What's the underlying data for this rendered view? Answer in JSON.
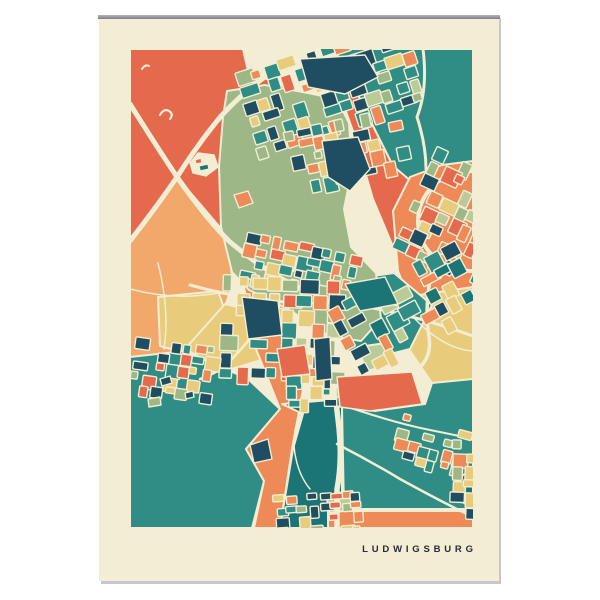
{
  "poster": {
    "title": "LUDWIGSBURG",
    "background_color": "#f2edd3",
    "title_color": "#2b2b33",
    "top_edge_color": "#8e8b9b",
    "shadow_color": "#c6c6ce"
  },
  "palette": {
    "cream": "#f2edd3",
    "salmon": "#e5694c",
    "orange": "#ee8a57",
    "lightOrange": "#f2a86b",
    "yellow": "#e9cc7b",
    "sage": "#9db886",
    "lightSage": "#bacb97",
    "teal": "#2f8d85",
    "darkTeal": "#1b7577",
    "navy": "#1f4d61",
    "ink": "#2b2b33"
  },
  "map": {
    "width": 343,
    "height": 479,
    "fields": [
      {
        "name": "left-meadow",
        "color": "lightOrange",
        "points": "0,192 47,128 100,190 102,238 88,276 60,312 0,316"
      },
      {
        "name": "left-field-1",
        "color": "yellow",
        "points": "28,248 88,242 100,276 62,306 30,297"
      },
      {
        "name": "left-field-2",
        "color": "yellow",
        "points": "55,300 95,255 150,268 148,306 95,322"
      },
      {
        "name": "northwest-district",
        "color": "salmon",
        "points": "0,0 113,0 118,22 160,40 178,62 150,120 108,176 100,190 47,128 0,192"
      },
      {
        "name": "northeast-forest",
        "color": "teal",
        "points": "203,0 343,0 343,116 302,150 263,117 233,57 216,18"
      },
      {
        "name": "northeast-band",
        "color": "salmon",
        "points": "216,18 233,57 263,117 302,150 308,190 288,225 266,205 243,150 224,85 208,40"
      },
      {
        "name": "east-ring-district",
        "color": "orange",
        "points": "343,112 343,308 318,318 290,278 268,222 263,162 280,128 312,116"
      },
      {
        "name": "east-farmland",
        "color": "yellow",
        "points": "276,248 343,238 343,332 302,334 276,296"
      },
      {
        "name": "center-green-wedge",
        "color": "teal",
        "points": "208,232 264,224 302,256 280,300 240,310 212,300"
      },
      {
        "name": "southeast-plain",
        "color": "teal",
        "points": "212,358 245,362 295,355 302,334 343,330 343,460 214,460"
      },
      {
        "name": "southwest-plain",
        "color": "teal",
        "points": "0,308 55,302 118,330 150,360 116,400 134,432 122,479 0,479"
      },
      {
        "name": "south-wedge",
        "color": "orange",
        "points": "112,228 150,238 174,335 162,400 150,479 124,479 134,432 116,400 150,360 126,300"
      },
      {
        "name": "south-forest",
        "color": "darkTeal",
        "points": "152,355 212,350 212,479 150,479 163,400 173,365"
      },
      {
        "name": "south-strip",
        "color": "orange",
        "points": "198,462 343,462 343,479 198,479"
      },
      {
        "name": "corner-grove",
        "color": "darkTeal",
        "points": "328,428 343,422 343,458 325,450"
      },
      {
        "name": "palace-park",
        "color": "sage",
        "points": "97,42 135,36 178,44 207,50 219,74 222,120 214,160 221,198 246,224 251,270 231,292 199,287 158,260 119,241 102,223 91,178 89,118 93,68"
      },
      {
        "name": "park-plot-1",
        "color": "lightSage",
        "points": "228,298 256,294 262,316 236,322"
      },
      {
        "name": "park-plot-2",
        "color": "lightSage",
        "points": "258,330 284,326 288,344 262,348"
      },
      {
        "name": "park-plot-3",
        "color": "lightSage",
        "points": "196,446 222,442 226,460 200,464"
      }
    ],
    "blobs": [
      {
        "color": "navy",
        "points": "170,10 235,6 248,28 215,45 178,38"
      },
      {
        "color": "navy",
        "points": "192,92 228,88 240,120 220,142 198,128"
      },
      {
        "color": "navy",
        "points": "112,248 148,252 152,286 118,290"
      },
      {
        "color": "darkTeal",
        "points": "215,235 255,228 268,255 230,262"
      },
      {
        "color": "salmon",
        "points": "147,300 175,296 180,325 152,328"
      },
      {
        "color": "navy",
        "points": "120,396 138,390 142,410 124,414"
      },
      {
        "color": "salmon",
        "points": "207,328 282,323 292,355 240,362 210,358"
      },
      {
        "color": "navy",
        "points": "184,290 200,288 202,330 186,332"
      },
      {
        "color": "navy",
        "points": "30,330 40,327 42,334 32,337"
      },
      {
        "color": "sage",
        "points": "18,350 30,348 31,356 19,358"
      },
      {
        "color": "navy",
        "points": "55,344 63,342 64,348 56,350"
      },
      {
        "color": "orange",
        "points": "104,146 118,142 123,154 109,159"
      },
      {
        "color": "cream",
        "points": "60,114 68,104 84,106 88,118 76,127 63,124"
      },
      {
        "color": "darkTeal",
        "points": "69,117 78,115 79,120 70,122"
      },
      {
        "color": "salmon",
        "points": "65,111 71,109 72,114 66,115"
      }
    ],
    "roads": [
      {
        "d": "M0,55 Q25,95 47,128 Q78,172 100,193 Q135,222 165,237 Q190,248 206,251",
        "w": 5
      },
      {
        "d": "M0,192 Q25,160 47,128 Q70,92 92,66 Q118,38 152,16 L178,1",
        "w": 5
      },
      {
        "d": "M152,16 Q190,30 225,24 Q245,20 258,30",
        "w": 3.5
      },
      {
        "d": "M293,0 Q298,40 287,68 Q296,96 296,120",
        "w": 3
      },
      {
        "d": "M302,220 Q294,258 299,288 Q302,308 288,320",
        "w": 3.5
      },
      {
        "d": "M205,228 L205,300 Q204,340 208,370 Q213,410 207,440 L207,479",
        "w": 5.5
      },
      {
        "d": "M60,236 Q140,258 205,253 Q275,262 343,287",
        "w": 3
      },
      {
        "d": "M207,395 Q240,412 270,430 Q310,452 343,468",
        "w": 2.5
      },
      {
        "d": "M215,357 Q265,374 300,381 Q325,386 343,390",
        "w": 2
      },
      {
        "d": "M128,280 Q112,300 96,316 Q85,325 70,330",
        "w": 2.5
      },
      {
        "d": "M172,360 Q160,385 166,410 Q170,428 180,440",
        "w": 1.5
      },
      {
        "d": "M0,240 Q45,252 88,244",
        "w": 1.5
      },
      {
        "d": "M28,214 Q40,262 34,300",
        "w": 1.5
      },
      {
        "d": "M276,260 Q310,300 343,302",
        "w": 1.5
      },
      {
        "ellipse": true,
        "cx": 340,
        "cy": 172,
        "rx": 52,
        "ry": 50,
        "w": 4
      },
      {
        "d": "M30,66 q4,-7 9,-4 q5,3 1,8",
        "w": 2.2
      },
      {
        "d": "M12,20 q3,-5 7,-3",
        "w": 2
      }
    ],
    "clusters": [
      {
        "name": "north-town",
        "cx": 200,
        "cy": 40,
        "w": 175,
        "h": 85,
        "rot": -18,
        "step": 15,
        "fill": 0.8,
        "seed": 7,
        "colors": [
          "navy",
          "navy",
          "navy",
          "teal",
          "teal",
          "orange",
          "orange",
          "salmon",
          "yellow",
          "sage",
          "lightSage"
        ]
      },
      {
        "name": "park-north-edge",
        "cx": 212,
        "cy": 100,
        "w": 105,
        "h": 58,
        "rot": -12,
        "step": 13,
        "fill": 0.55,
        "seed": 11,
        "colors": [
          "navy",
          "navy",
          "teal",
          "orange",
          "yellow",
          "sage"
        ]
      },
      {
        "name": "east-ring-village",
        "cx": 332,
        "cy": 166,
        "w": 100,
        "h": 100,
        "rot": 25,
        "step": 14,
        "fill": 0.68,
        "seed": 13,
        "colors": [
          "orange",
          "orange",
          "teal",
          "navy",
          "sage",
          "yellow",
          "salmon",
          "lightSage"
        ]
      },
      {
        "name": "northwest-city",
        "cx": 170,
        "cy": 218,
        "w": 115,
        "h": 48,
        "rot": 12,
        "step": 13,
        "fill": 0.78,
        "seed": 17,
        "colors": [
          "teal",
          "teal",
          "navy",
          "orange",
          "orange",
          "salmon",
          "yellow",
          "sage"
        ]
      },
      {
        "name": "city-center",
        "cx": 152,
        "cy": 282,
        "w": 120,
        "h": 105,
        "rot": 2,
        "step": 15,
        "fill": 0.85,
        "seed": 19,
        "colors": [
          "navy",
          "navy",
          "teal",
          "teal",
          "orange",
          "salmon",
          "yellow",
          "yellow",
          "sage",
          "lightSage"
        ]
      },
      {
        "name": "east-city",
        "cx": 272,
        "cy": 266,
        "w": 130,
        "h": 78,
        "rot": -28,
        "step": 16,
        "fill": 0.7,
        "seed": 23,
        "colors": [
          "yellow",
          "yellow",
          "navy",
          "teal",
          "darkTeal",
          "orange",
          "lightSage"
        ]
      },
      {
        "name": "west-hamlet",
        "cx": 40,
        "cy": 320,
        "w": 78,
        "h": 56,
        "rot": 8,
        "step": 12,
        "fill": 0.62,
        "seed": 29,
        "colors": [
          "teal",
          "navy",
          "orange",
          "yellow",
          "salmon",
          "sage"
        ]
      },
      {
        "name": "southeast-hamlet",
        "cx": 300,
        "cy": 395,
        "w": 68,
        "h": 42,
        "rot": 15,
        "step": 12,
        "fill": 0.58,
        "seed": 31,
        "colors": [
          "navy",
          "yellow",
          "teal",
          "sage",
          "orange"
        ]
      },
      {
        "name": "south-hamlet",
        "cx": 188,
        "cy": 462,
        "w": 85,
        "h": 34,
        "rot": -4,
        "step": 11,
        "fill": 0.62,
        "seed": 37,
        "colors": [
          "orange",
          "yellow",
          "teal",
          "sage",
          "salmon",
          "navy"
        ]
      },
      {
        "name": "east-edge-strip",
        "cx": 333,
        "cy": 432,
        "w": 22,
        "h": 78,
        "rot": 2,
        "step": 13,
        "fill": 0.85,
        "seed": 43,
        "colors": [
          "navy",
          "yellow",
          "salmon",
          "sage",
          "orange"
        ]
      },
      {
        "name": "city-south-edge",
        "cx": 185,
        "cy": 340,
        "w": 55,
        "h": 28,
        "rot": 0,
        "step": 12,
        "fill": 0.7,
        "seed": 41,
        "colors": [
          "navy",
          "teal",
          "orange",
          "yellow"
        ]
      }
    ]
  }
}
